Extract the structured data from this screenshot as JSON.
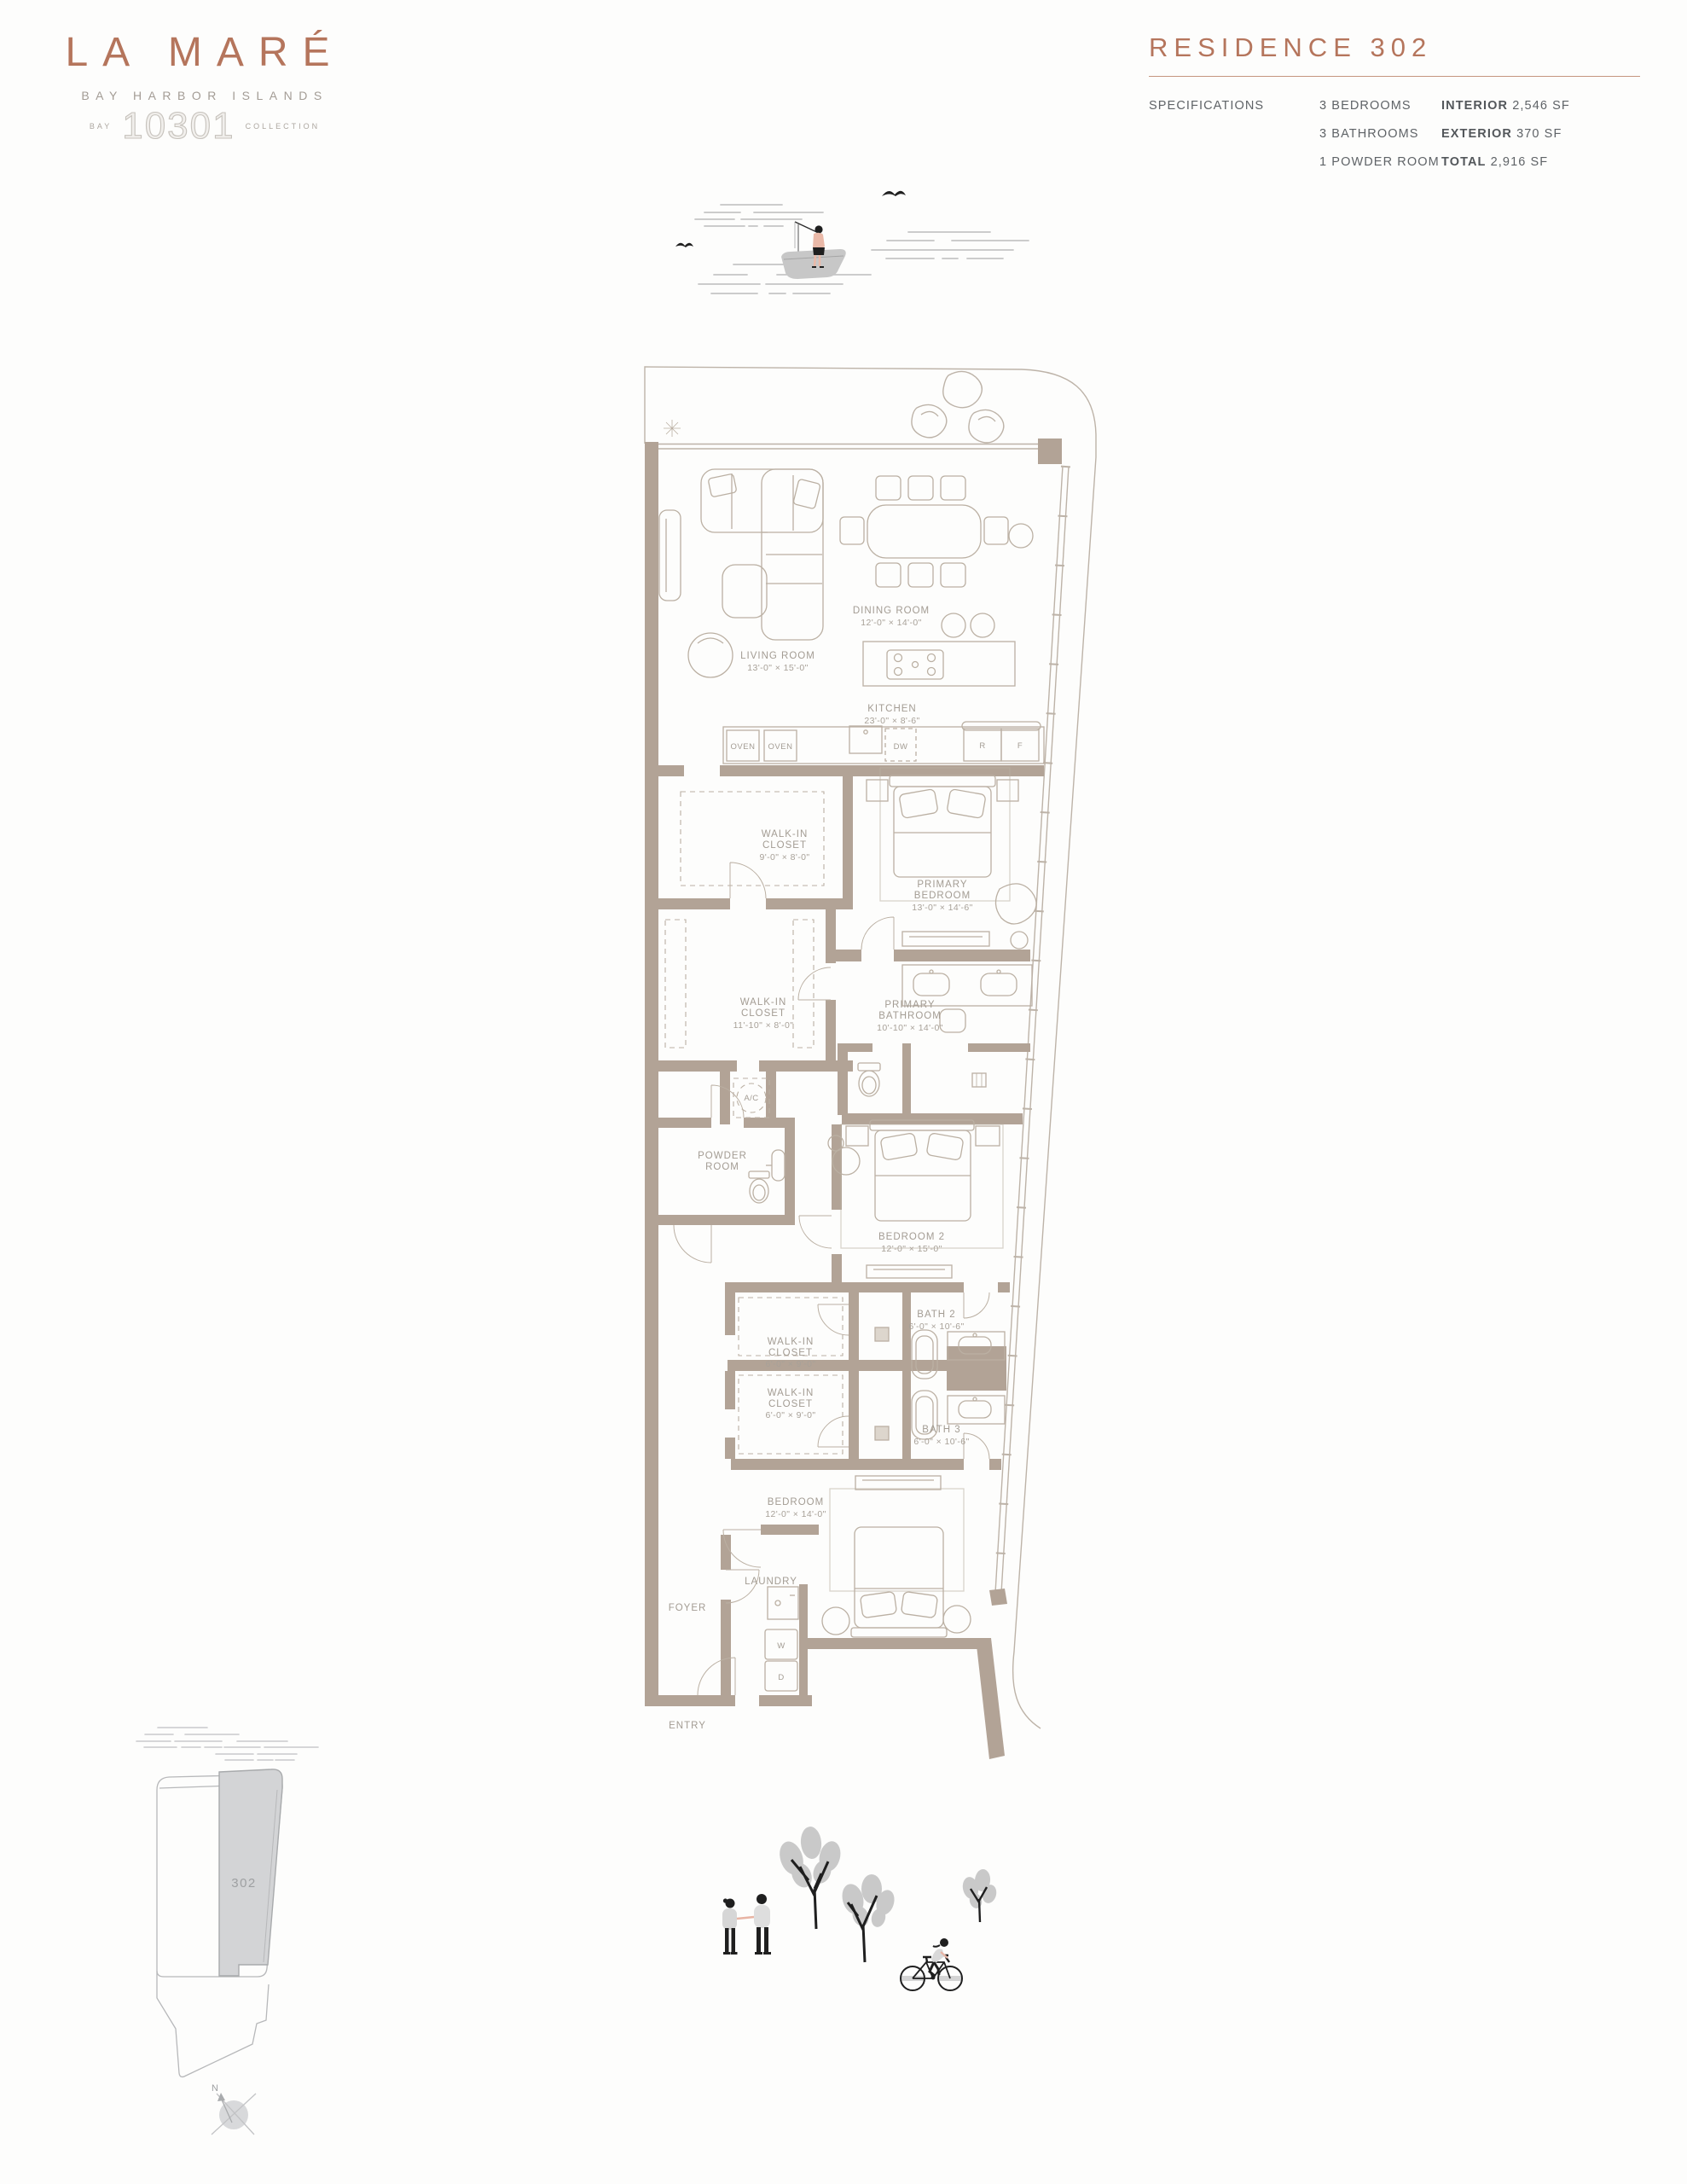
{
  "brand": {
    "name": "LA MARÉ",
    "location": "BAY HARBOR ISLANDS",
    "collection_pre": "BAY",
    "collection_num": "10301",
    "collection_post": "COLLECTION"
  },
  "header": {
    "title": "RESIDENCE 302",
    "specs_label": "SPECIFICATIONS",
    "bedrooms": "3 BEDROOMS",
    "bathrooms": "3 BATHROOMS",
    "powder": "1 POWDER ROOM",
    "interior_label": "INTERIOR",
    "interior_value": "2,546 SF",
    "exterior_label": "EXTERIOR",
    "exterior_value": "370 SF",
    "total_label": "TOTAL",
    "total_value": "2,916 SF"
  },
  "plan": {
    "living_1": "LIVING ROOM",
    "living_2": "13'-0\" × 15'-0\"",
    "dining_1": "DINING ROOM",
    "dining_2": "12'-0\" × 14'-0\"",
    "kitchen_1": "KITCHEN",
    "kitchen_2": "23'-0\" × 8'-6\"",
    "oven1": "OVEN",
    "oven2": "OVEN",
    "dw": "DW",
    "r": "R",
    "f": "F",
    "wic1_1": "WALK-IN",
    "wic1_2": "CLOSET",
    "wic1_3": "9'-0\" × 8'-0\"",
    "pbed_1": "PRIMARY",
    "pbed_2": "BEDROOM",
    "pbed_3": "13'-0\" × 14'-6\"",
    "wic2_1": "WALK-IN",
    "wic2_2": "CLOSET",
    "wic2_3": "11'-10\" × 8'-0\"",
    "pbath_1": "PRIMARY",
    "pbath_2": "BATHROOM",
    "pbath_3": "10'-10\" × 14'-0\"",
    "ac": "A/C",
    "powder_1": "POWDER",
    "powder_2": "ROOM",
    "bed2_1": "BEDROOM 2",
    "bed2_2": "12'-0\" × 15'-0\"",
    "wic3_1": "WALK-IN",
    "wic3_2": "CLOSET",
    "wic3_3": "6'-0\" × 9'-0\"",
    "wic4_1": "WALK-IN",
    "wic4_2": "CLOSET",
    "wic4_3": "6'-0\" × 9'-0\"",
    "bath2_1": "BATH 2",
    "bath2_2": "6'-0\" × 10'-6\"",
    "bath3_1": "BATH 3",
    "bath3_2": "6'-0\" × 10'-6\"",
    "bed3_1": "BEDROOM",
    "bed3_2": "12'-0\" × 14'-0\"",
    "laundry": "LAUNDRY",
    "washer": "W",
    "dryer": "D",
    "foyer": "FOYER",
    "entry": "ENTRY"
  },
  "keyplan": {
    "unit": "302",
    "north": "N"
  },
  "colors": {
    "accent": "#b5755c",
    "wall": "#b2a396",
    "plan_line": "#bbb0a3",
    "plan_label": "#a39c93",
    "spec_text": "#5f6367",
    "keyplan_fill": "#d3d4d6",
    "illustration_black": "#1f1f1f",
    "tree_gray": "#c9c9c9"
  }
}
